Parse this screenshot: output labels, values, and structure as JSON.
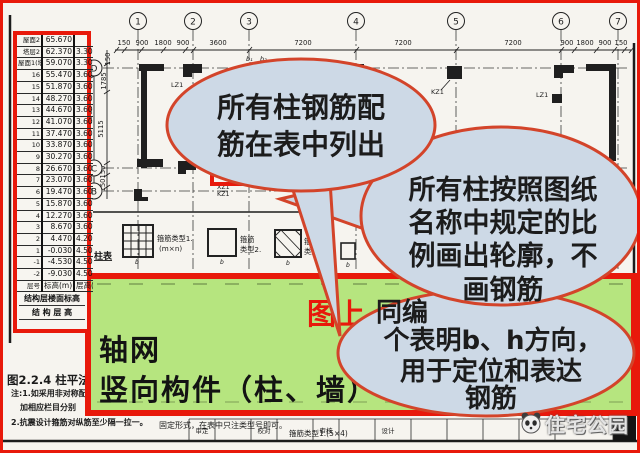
{
  "colors": {
    "highlight_red": "#e8190b",
    "bubble_stroke": "#d3442a",
    "bubble_fill": "#cdd9e6",
    "green_fill": "#b6e57f"
  },
  "floor_table": {
    "rows": [
      [
        "屋面2",
        "65.670",
        ""
      ],
      [
        "塔层2",
        "62.370",
        "3.30"
      ],
      [
        "屋面1(塔层1)",
        "59.070",
        "3.30"
      ],
      [
        "16",
        "55.470",
        "3.60"
      ],
      [
        "15",
        "51.870",
        "3.60"
      ],
      [
        "14",
        "48.270",
        "3.60"
      ],
      [
        "13",
        "44.670",
        "3.60"
      ],
      [
        "12",
        "41.070",
        "3.60"
      ],
      [
        "11",
        "37.470",
        "3.60"
      ],
      [
        "10",
        "33.870",
        "3.60"
      ],
      [
        "9",
        "30.270",
        "3.60"
      ],
      [
        "8",
        "26.670",
        "3.60"
      ],
      [
        "7",
        "23.070",
        "3.60"
      ],
      [
        "6",
        "19.470",
        "3.60"
      ],
      [
        "5",
        "15.870",
        "3.60"
      ],
      [
        "4",
        "12.270",
        "3.60"
      ],
      [
        "3",
        "8.670",
        "3.60"
      ],
      [
        "2",
        "4.470",
        "4.20"
      ],
      [
        "1",
        "-0.030",
        "4.50"
      ],
      [
        "-1",
        "-4.530",
        "4.50"
      ],
      [
        "-2",
        "-9.030",
        "4.50"
      ],
      [
        "层号",
        "标高(m)",
        "层高(m)"
      ]
    ],
    "footer_line1": "结构层楼面标高",
    "footer_line2": "结 构 层 高"
  },
  "drawing": {
    "top_axis": [
      "1",
      "2",
      "3",
      "4",
      "5",
      "6",
      "7"
    ],
    "left_axis": [
      "D",
      "C",
      "B"
    ],
    "top_dims": [
      "150",
      "900",
      "1800",
      "900",
      "3600",
      "7200",
      "7200",
      "7200",
      "900",
      "1800",
      "900",
      "150"
    ],
    "left_dims": [
      "150",
      "1785",
      "5115",
      "6900",
      "1800",
      "150",
      "150"
    ],
    "labels": {
      "kz1": "KZ1",
      "kz1_b": "KZ1",
      "lz1_a": "LZ1",
      "lz1_b": "LZ1",
      "xz1": "XZ1",
      "b1": "b₁",
      "b2": "b₂",
      "b": "b",
      "column_table": "柱表",
      "stirrup1": "箍筋类型1.",
      "stirrup1_size": "(m×n)",
      "stirrup2": "箍筋",
      "stirrup2_b": "类型2.",
      "stirrup3": "箍筋",
      "stirrup3_b": "类型3."
    }
  },
  "bubbles": {
    "b1": [
      "所有柱钢筋配",
      "筋在表中列出"
    ],
    "b2": [
      "所有柱按照图纸",
      "名称中规定的比",
      "例画出轮廓，不",
      "画钢筋"
    ],
    "b3": [
      "同编",
      "个表明b、h方向，",
      "用于定位和表达",
      "钢筋"
    ]
  },
  "green_box": {
    "red_label": "图上",
    "line1": "轴网",
    "line2": "竖向构件（柱、墙）"
  },
  "caption": {
    "figure": "图2.2.4 柱平法施",
    "note1": "注:1.如采用非对称配",
    "note2": "加相应栏目分别",
    "note3": "2.抗震设计箍筋对纵筋至少隔一拉一。",
    "note3b": "固定形式，在表中只注类型号即可。",
    "note4": "箍筋类型1.(5×4)"
  },
  "titleblock": {
    "cells": [
      "审定",
      "校对",
      "审核",
      "设计"
    ],
    "watermark": "住宅公园"
  }
}
